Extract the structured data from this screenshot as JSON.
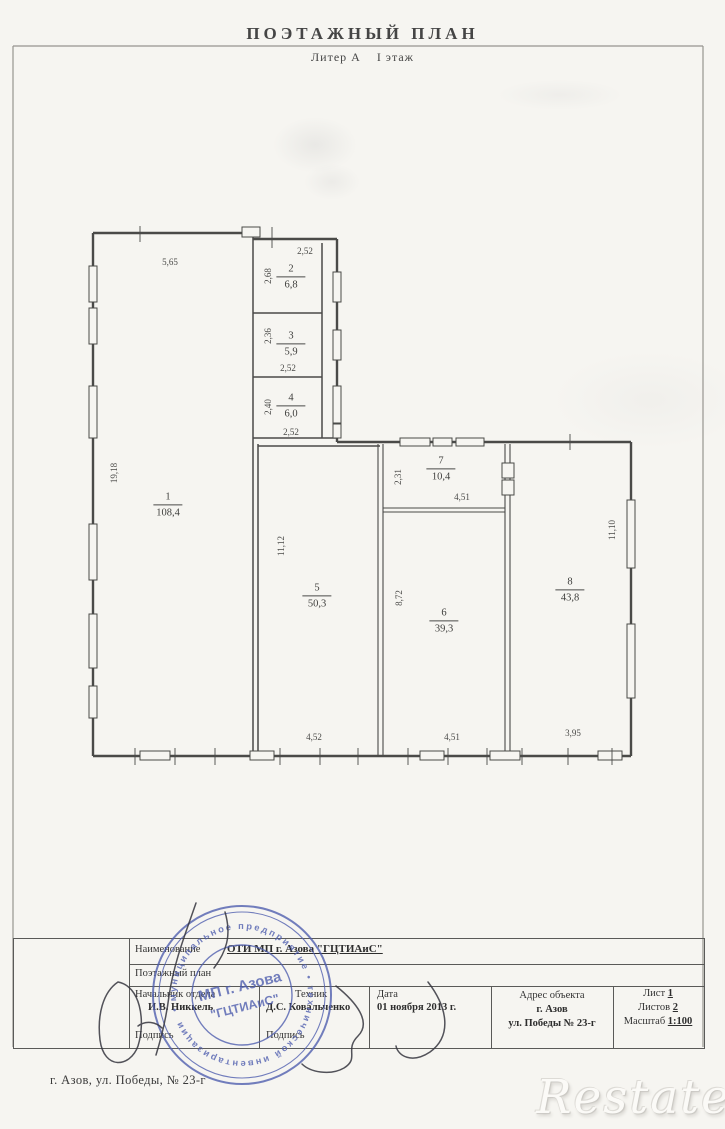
{
  "page": {
    "title": "ПОЭТАЖНЫЙ ПЛАН",
    "subtitle": "Литер А    I этаж",
    "footer_address": "г. Азов, ул. Победы, № 23-г",
    "watermark": "Restate"
  },
  "plan": {
    "rooms": [
      {
        "number": "1",
        "area": "108,4"
      },
      {
        "number": "2",
        "area": "6,8"
      },
      {
        "number": "3",
        "area": "5,9"
      },
      {
        "number": "4",
        "area": "6,0"
      },
      {
        "number": "5",
        "area": "50,3"
      },
      {
        "number": "6",
        "area": "39,3"
      },
      {
        "number": "7",
        "area": "10,4"
      },
      {
        "number": "8",
        "area": "43,8"
      }
    ],
    "dims": {
      "room1_top": "5,65",
      "room1_left": "19,18",
      "room2_top": "2,52",
      "room2_left": "2,68",
      "room3_left": "2,36",
      "room3_bottom": "2,52",
      "room4_left": "2,40",
      "room4_bottom": "2,52",
      "room5_left": "11,12",
      "room5_bottom": "4,52",
      "room6_left": "8,72",
      "room6_bottom": "4,51",
      "room7_left": "2,31",
      "room7_bottom": "4,51",
      "room8_right": "11,10",
      "room8_bottom": "3,95"
    }
  },
  "title_block": {
    "name_label": "Наименование",
    "name_value": "ОТИ МП г. Азова \"ГЦТИАиС\"",
    "doc_type": "Поэтажный план",
    "chief_label": "Начальник отдела",
    "chief_name": "И.В. Никкель",
    "tech_label": "Техник",
    "tech_name": "Д.С. Ковальченко",
    "signature_label": "Подпись",
    "date_label": "Дата",
    "date_value": "01 ноября 2013 г.",
    "address_label": "Адрес объекта",
    "address_city": "г. Азов",
    "address_street": "ул. Победы № 23-г",
    "sheet_label": "Лист",
    "sheet_value": "1",
    "sheets_label": "Листов",
    "sheets_value": "2",
    "scale_label": "Масштаб",
    "scale_value": "1:100"
  },
  "stamp": {
    "ring_text": "• муниципальное предприятие • технической инвентаризации",
    "center_line1": "МП г. Азова",
    "center_line2": "\"ГЦТИАиС\""
  },
  "colors": {
    "stamp_blue": "#4d5cae",
    "line_gray": "#4a4a48"
  }
}
